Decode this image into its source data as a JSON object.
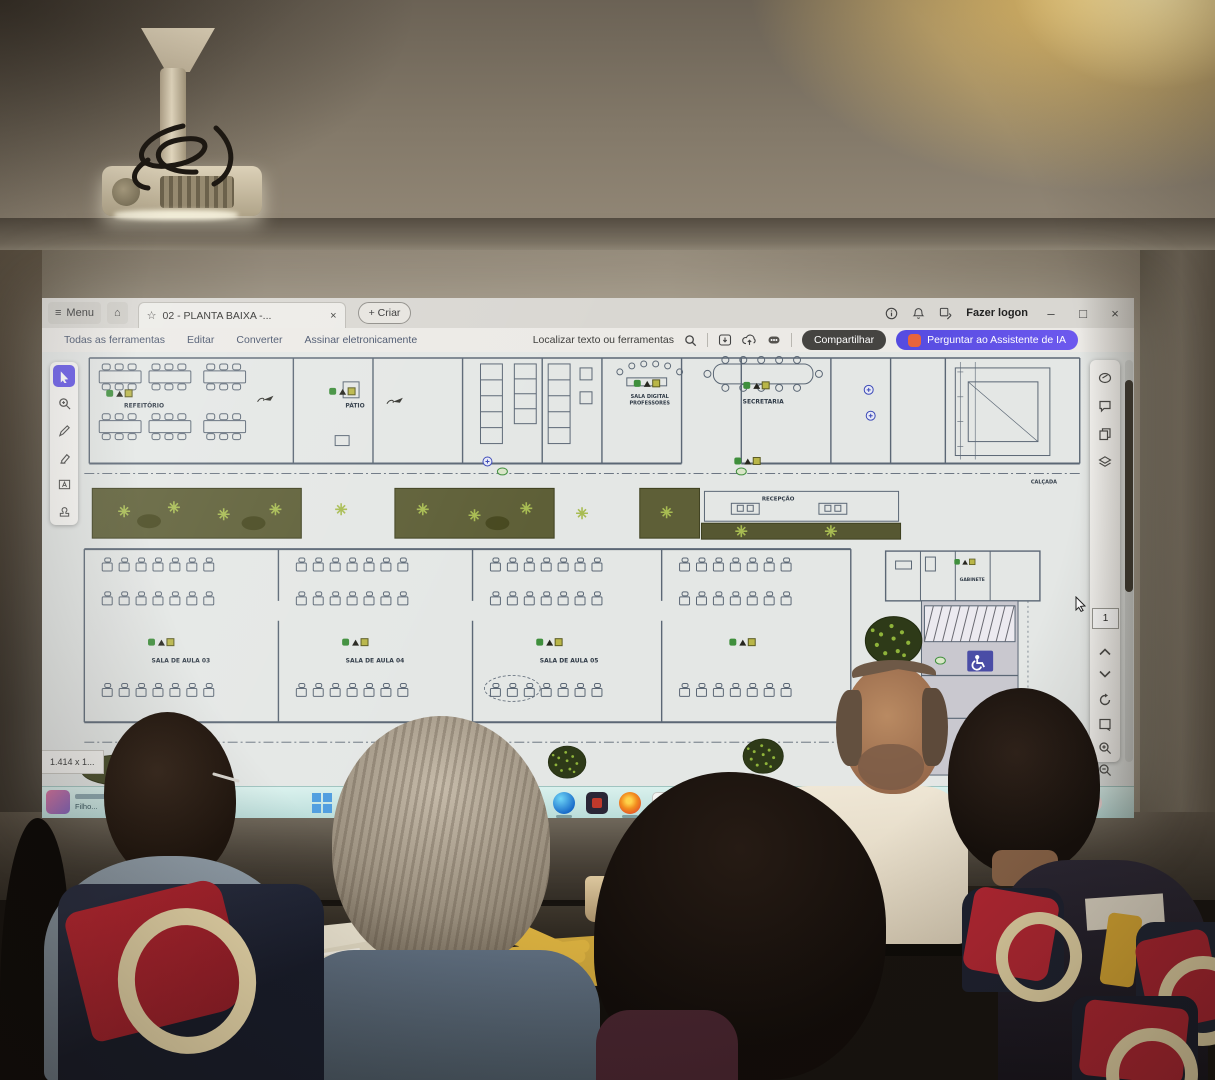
{
  "window": {
    "menu_label": "Menu",
    "tab_title": "02 - PLANTA BAIXA -...",
    "create_label": "+ Criar",
    "login_label": "Fazer logon"
  },
  "toolbar": {
    "item_all_tools": "Todas as ferramentas",
    "item_edit": "Editar",
    "item_convert": "Converter",
    "item_sign": "Assinar eletronicamente",
    "search_label": "Localizar texto ou ferramentas",
    "share_label": "Compartilhar",
    "ai_label": "Perguntar ao Assistente de IA"
  },
  "viewer": {
    "page_number": "1",
    "size_indicator": "1.414 x 1..."
  },
  "plan": {
    "labels": {
      "refeitorio": "REFEITÓRIO",
      "patio": "PÁTIO",
      "sala_digital_1": "SALA DIGITAL",
      "sala_digital_2": "PROFESSORES",
      "secretaria": "SECRETARIA",
      "recepcao": "RECEPÇÃO",
      "sala03": "SALA DE AULA 03",
      "sala04": "SALA DE AULA 04",
      "sala05": "SALA DE AULA 05",
      "gabinete": "GABINETE",
      "calcada": "CALÇADA"
    }
  },
  "taskbar": {
    "widget_caption": "Filho..."
  },
  "colors": {
    "accent_purple": "#6254e8",
    "ai_pill": "#5a50e8",
    "share_pill": "#454441",
    "taskbar_teal": "#cdeae6",
    "sign_blue": "#4a4da6",
    "garden_green": "#5e5f37"
  }
}
